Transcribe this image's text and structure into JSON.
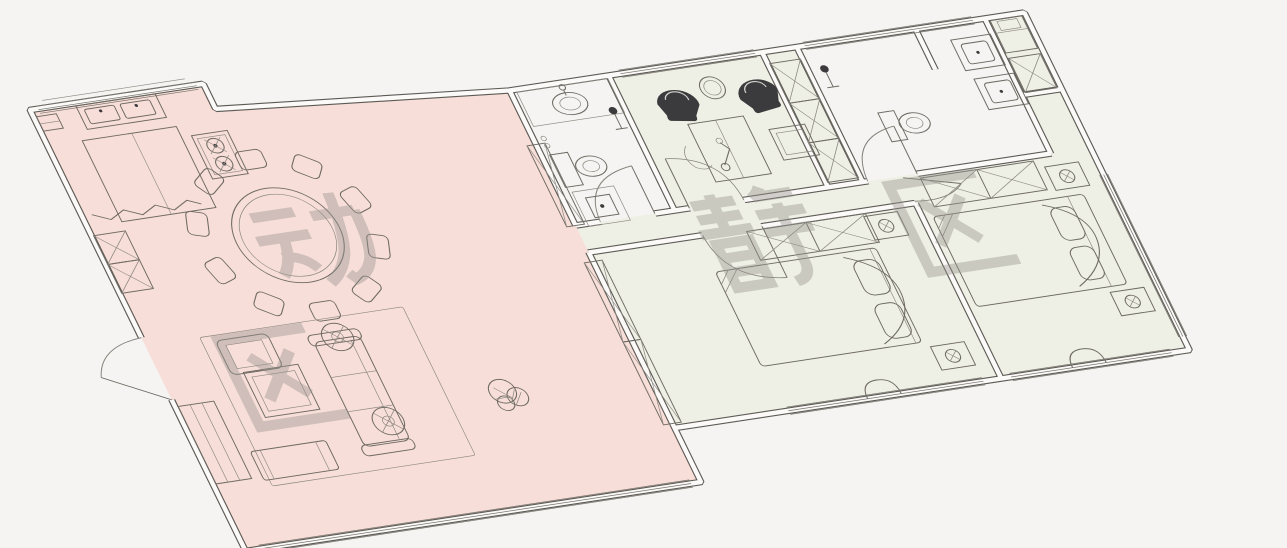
{
  "colors": {
    "background": "#f5f4f2",
    "zone_dynamic": "#f8ded8",
    "zone_quiet": "#eef0e5",
    "wall": "#5d5a55",
    "line": "#6e6a63",
    "dark_furniture": "#3b3a3c",
    "watermark": "#98948f"
  },
  "zones": {
    "dynamic": {
      "label": "动区",
      "characters": [
        "动",
        "区"
      ]
    },
    "quiet": {
      "label": "静区",
      "characters": [
        "静",
        "区"
      ]
    }
  }
}
